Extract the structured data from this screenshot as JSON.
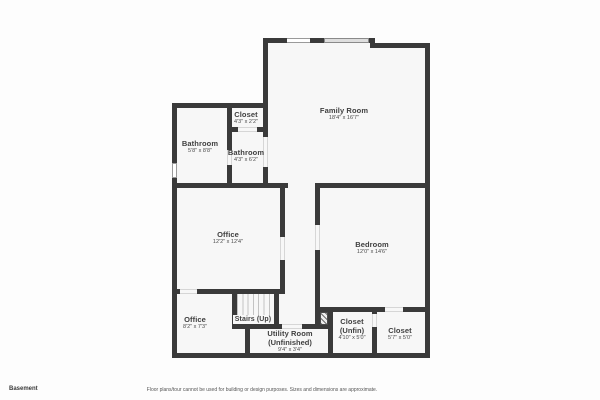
{
  "colors": {
    "wall": "#3a3a3a",
    "room_fill": "#f7f7f7",
    "window_fill": "#dedede",
    "text": "#3f3f3f"
  },
  "rooms": {
    "closet_top": {
      "name": "Closet",
      "dims": "4'3\" x 2'2\""
    },
    "bathroom_left": {
      "name": "Bathroom",
      "dims": "5'8\" x 8'8\""
    },
    "bathroom_mid": {
      "name": "Bathroom",
      "dims": "4'3\" x 6'2\""
    },
    "family_room": {
      "name": "Family Room",
      "dims": "18'4\" x 16'7\""
    },
    "office_main": {
      "name": "Office",
      "dims": "12'2\" x 12'4\""
    },
    "bedroom": {
      "name": "Bedroom",
      "dims": "12'0\" x 14'6\""
    },
    "stairs": {
      "name": "Stairs (Up)"
    },
    "office_small": {
      "name": "Office",
      "dims": "8'2\" x 7'3\""
    },
    "utility": {
      "name": "Utility Room",
      "qualifier": "(Unfinished)",
      "dims": "9'4\" x 3'4\""
    },
    "closet_unfin": {
      "name": "Closet",
      "qualifier": "(Unfin)",
      "dims": "4'10\" x 5'0\""
    },
    "closet_right": {
      "name": "Closet",
      "dims": "5'7\" x 5'0\""
    }
  },
  "footer": {
    "floor_label": "Basement",
    "disclaimer": "Floor plans/tour cannot be used for building or design purposes. Sizes and dimensions are approximate."
  }
}
